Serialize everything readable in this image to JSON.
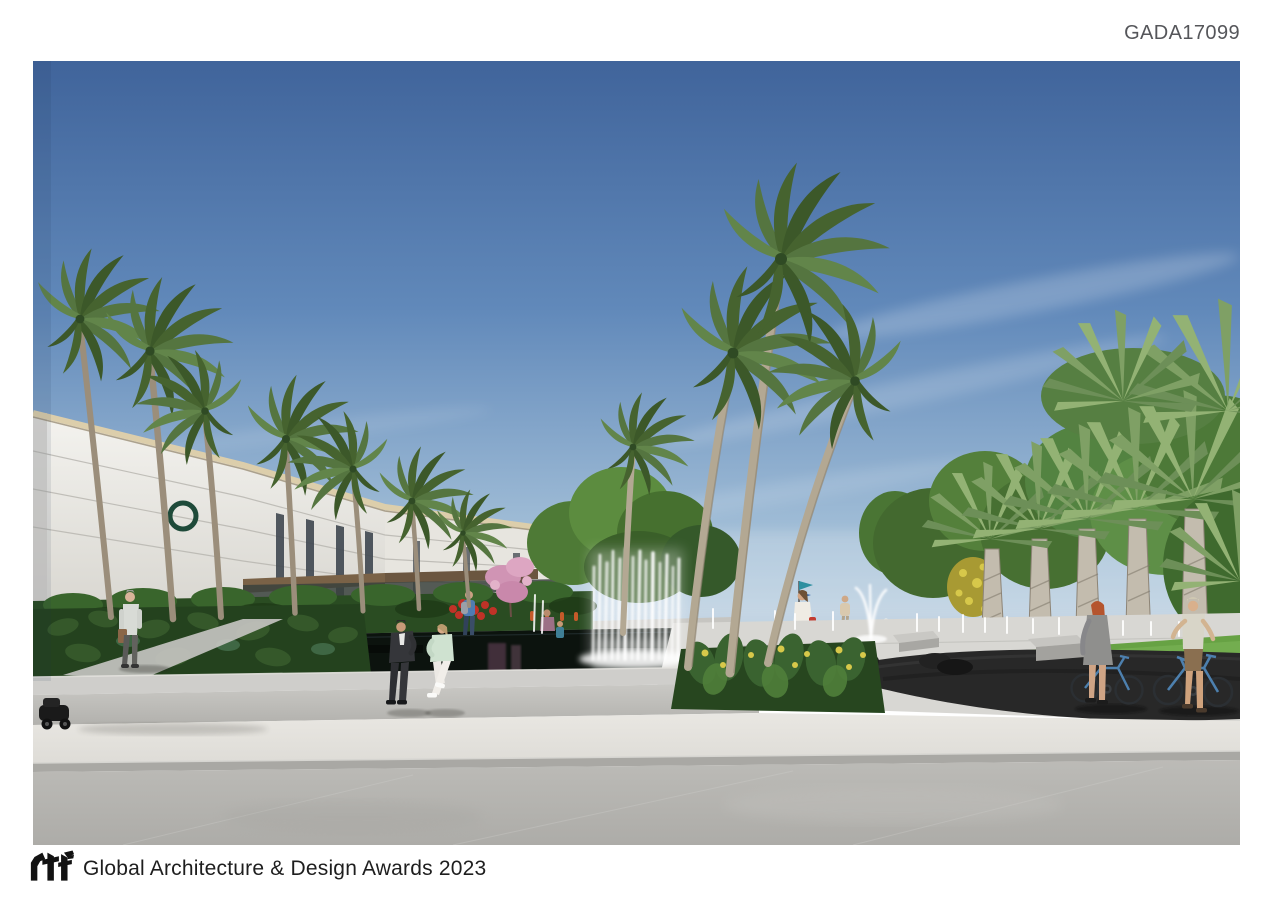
{
  "header": {
    "entry_code": "GADA17099"
  },
  "footer": {
    "logo_name": "rtf",
    "award_text": "Global Architecture & Design Awards 2023"
  },
  "artwork": {
    "type": "architectural-rendering",
    "alt": "Rendering of a tropical waterfront plaza: white multi-storey building with green ring logo at left, rows of palm trees, a dark reflecting pool with a wall of fountain jets, flower beds, benches and stone seats, pedestrians, a couple seated on the pool edge, two people walking blue bicycles on a dark curved path at right, wide light concrete pavement in the foreground under a blue sky with wispy clouds",
    "palette": {
      "sky_top": "#40649b",
      "sky_horizon": "#cfdde8",
      "foliage_dark": "#3c5829",
      "foliage_light": "#62854a",
      "building_facade": "#f2f1ed",
      "logo_ring_green": "#1e4a39",
      "pool_water": "#0c130e",
      "fountain_white": "#ffffff",
      "pavement_light": "#e6e4df",
      "pavement_dark": "#b7b6b2",
      "bike_path": "#282828",
      "bicycle_blue": "#4d80ae",
      "accent_flower_red": "#c03227",
      "accent_flower_pink": "#d094b4",
      "accent_flower_yellow": "#d7c84a"
    }
  }
}
